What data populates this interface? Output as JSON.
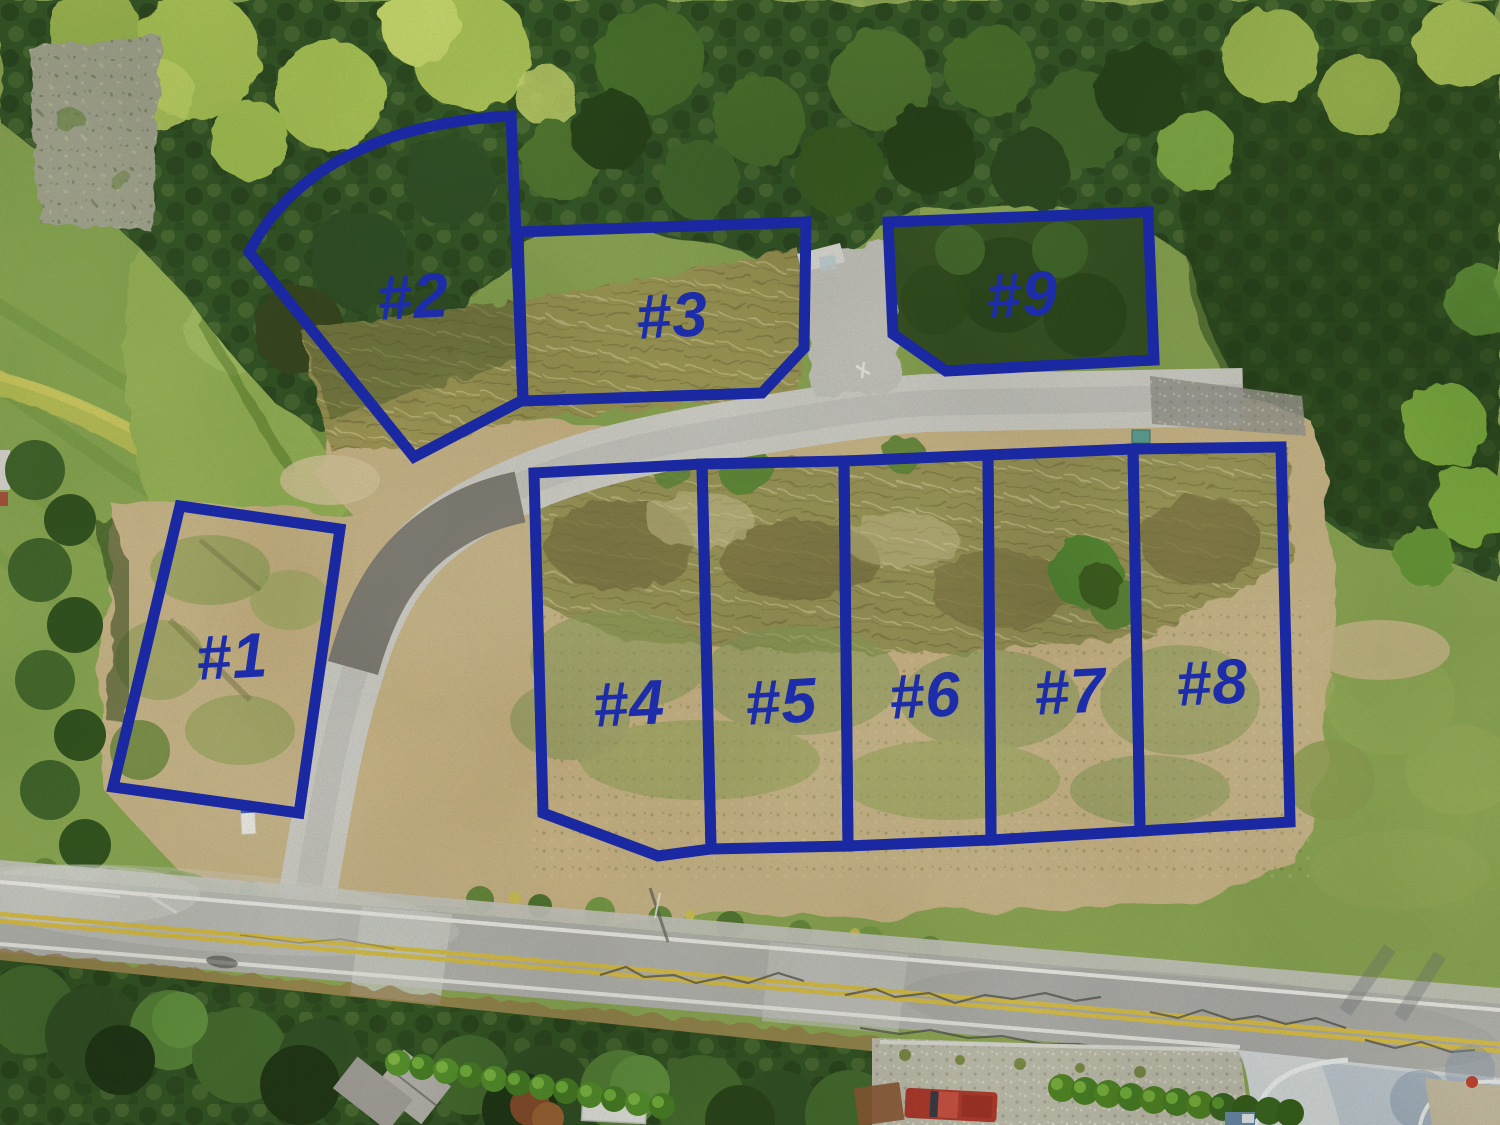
{
  "photo": {
    "scene": "aerial-drone-view-of-9-vacant-subdivision-lots",
    "palette": {
      "forest_green": "#2f4e20",
      "grass_green": "#7e9a4b",
      "cleared_dirt_tan": "#c4ac7d",
      "brush_olive": "#8d8750",
      "access_road_gray": "#cac8c3",
      "asphalt_patch_dark": "#6f6b66",
      "main_road_gray": "#a9a8a5",
      "road_line_yellow": "#d2b440",
      "road_line_white": "#eceae6",
      "corner_concrete": "#ccd0d3",
      "hedge_green": "#4c8226",
      "truck_red": "#a23126"
    }
  },
  "annotation": {
    "outline_color": "#1a28a2",
    "label_color": "#1d2da9",
    "outline_width": 11,
    "label_font_size": 63,
    "lots": [
      {
        "n": "1",
        "label": "#1",
        "path": "M180,506 L340,529 L299,813 L113,787 Z",
        "lx": 232,
        "ly": 657,
        "rot": -3
      },
      {
        "n": "2",
        "label": "#2",
        "path": "M511,116 C392,122 295,164 249,252 L414,457 L523,400 Z",
        "lx": 413,
        "ly": 297,
        "rot": -3
      },
      {
        "n": "3",
        "label": "#3",
        "path": "M518,232 L806,222 L804,348 L762,393 L523,401 Z",
        "lx": 672,
        "ly": 316,
        "rot": -3
      },
      {
        "n": "4",
        "label": "#4",
        "path": "M534,473 L702,464 L711,849 L658,856 L543,813 Z",
        "lx": 629,
        "ly": 704,
        "rot": -3
      },
      {
        "n": "5",
        "label": "#5",
        "path": "M702,464 L844,461 L848,846 L711,849 Z",
        "lx": 781,
        "ly": 702,
        "rot": -3
      },
      {
        "n": "6",
        "label": "#6",
        "path": "M844,461 L988,455 L991,840 L848,846 Z",
        "lx": 925,
        "ly": 696,
        "rot": -3
      },
      {
        "n": "7",
        "label": "#7",
        "path": "M988,455 L1133,449 L1140,831 L991,840 Z",
        "lx": 1070,
        "ly": 692,
        "rot": -3
      },
      {
        "n": "8",
        "label": "#8",
        "path": "M1133,449 L1281,447 L1290,822 L1140,831 Z",
        "lx": 1212,
        "ly": 683,
        "rot": -3
      },
      {
        "n": "9",
        "label": "#9",
        "path": "M888,222 L1148,212 L1154,360 L946,371 L893,334 Z",
        "lx": 1022,
        "ly": 295,
        "rot": -3
      }
    ]
  }
}
